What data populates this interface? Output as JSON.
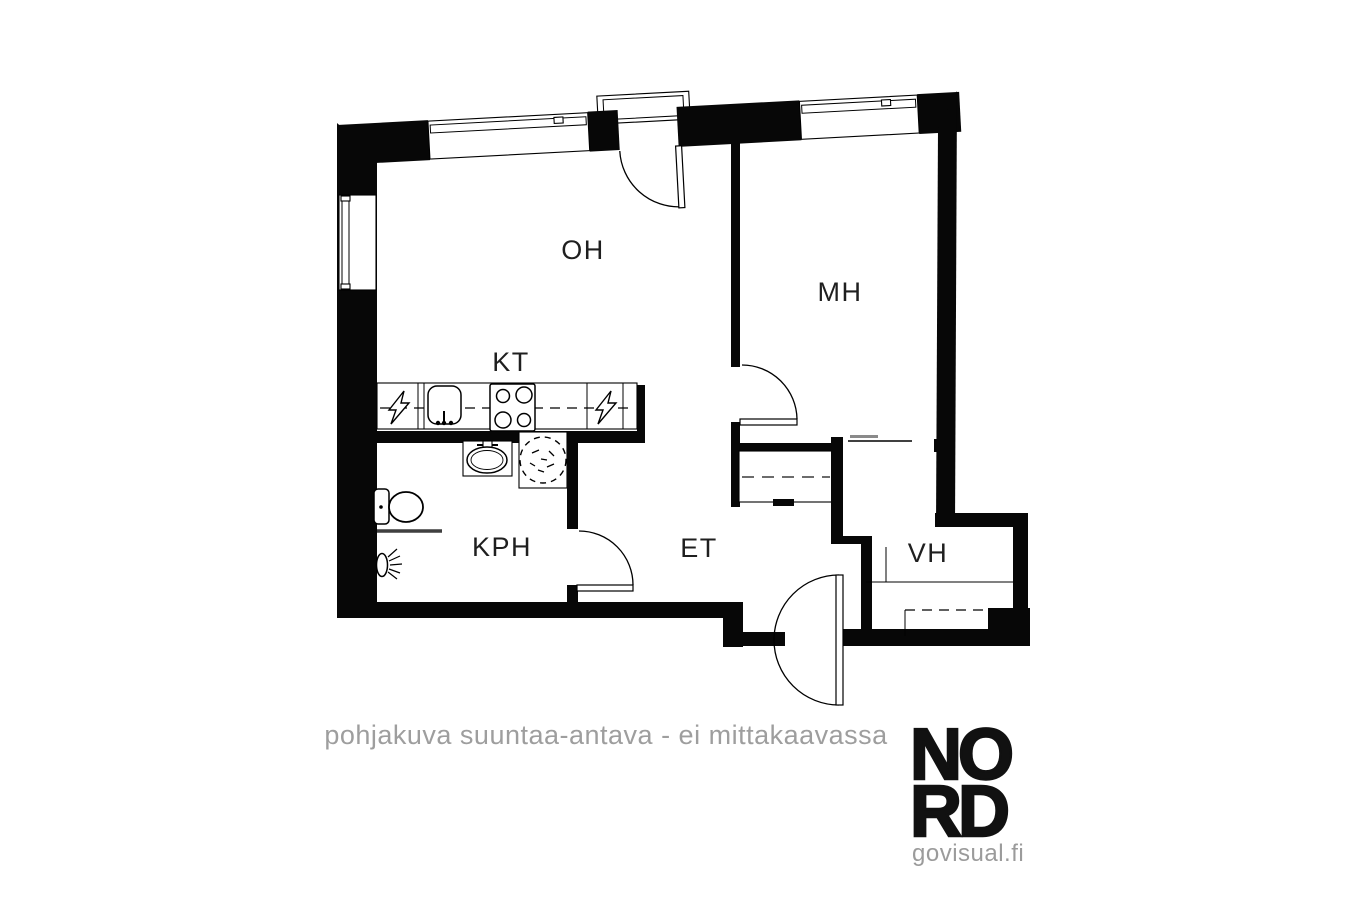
{
  "plan": {
    "rooms": {
      "oh": {
        "label": "OH"
      },
      "mh": {
        "label": "MH"
      },
      "kt": {
        "label": "KT"
      },
      "kph": {
        "label": "KPH"
      },
      "et": {
        "label": "ET"
      },
      "vh": {
        "label": "VH"
      }
    },
    "disclaimer": "pohjakuva suuntaa-antava - ei mittakaavassa",
    "colors": {
      "wall": "#070707",
      "label": "#1f1f1f",
      "muted_gray": "#9e9e9e"
    }
  },
  "logo": {
    "line1": "NO",
    "line2": "RD",
    "website": "govisual.fi"
  }
}
